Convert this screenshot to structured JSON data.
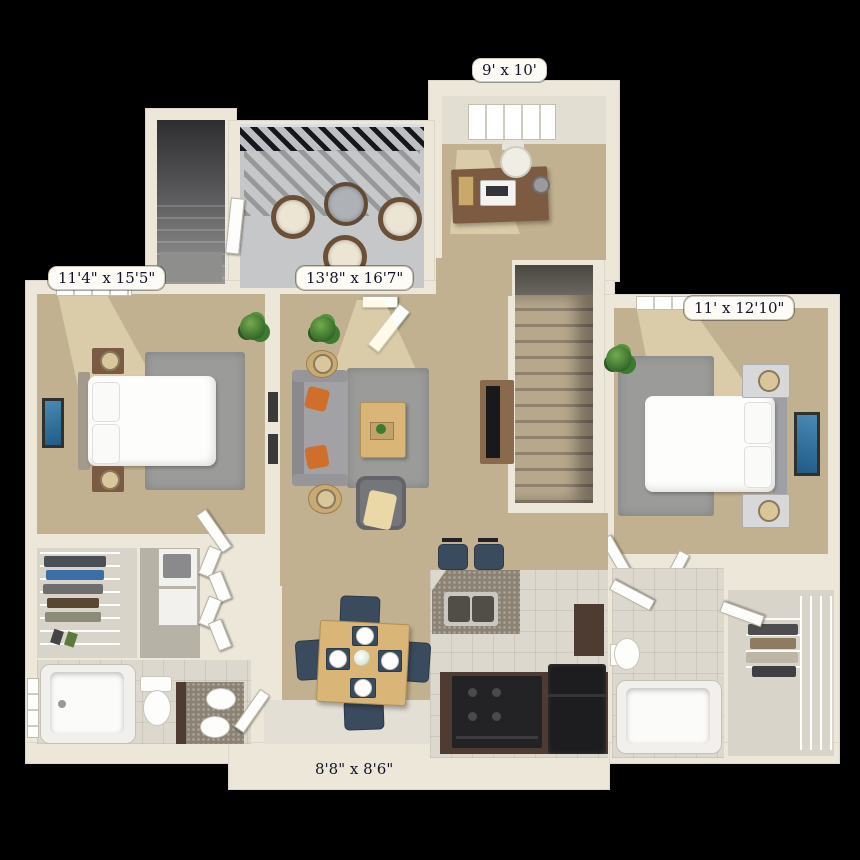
{
  "scene": {
    "kind": "3D apartment floor plan, top-down view",
    "background": "#000000"
  },
  "rooms": {
    "office": {
      "dimensions": "9' x 10'",
      "furniture": [
        "desk",
        "desk-chair",
        "laptop",
        "desk-lamp",
        "window"
      ]
    },
    "balcony": {
      "furniture": [
        "railing",
        "round-glass-table",
        "wicker-chair",
        "wicker-chair",
        "wicker-chair"
      ]
    },
    "entry_stairwell": {
      "furniture": [
        "stairs-down"
      ]
    },
    "bedroom_left": {
      "dimensions": "11'4\" x 15'5\"",
      "furniture": [
        "bed",
        "nightstand",
        "table-lamp",
        "nightstand",
        "table-lamp",
        "area-rug",
        "wall-art",
        "plant",
        "window"
      ]
    },
    "living_room": {
      "dimensions": "13'8\" x 16'7\"",
      "furniture": [
        "sofa",
        "accent-pillows",
        "coffee-table",
        "armchair",
        "tv-console",
        "area-rug",
        "side-table",
        "table-lamp",
        "plant",
        "sliding-door"
      ]
    },
    "stairs": {
      "furniture": [
        "staircase"
      ]
    },
    "bedroom_right": {
      "dimensions": "11' x 12'10\"",
      "furniture": [
        "bed",
        "nightstand",
        "table-lamp",
        "nightstand",
        "table-lamp",
        "area-rug",
        "wall-art",
        "plant",
        "windows"
      ]
    },
    "kitchen": {
      "furniture": [
        "breakfast-bar",
        "double-sink",
        "bar-stool",
        "bar-stool",
        "range",
        "refrigerator",
        "cabinets"
      ]
    },
    "dining": {
      "dimensions": "8'8\" x 8'6\"",
      "furniture": [
        "dining-table",
        "dining-chair",
        "dining-chair",
        "dining-chair",
        "dining-chair",
        "place-settings",
        "flowers"
      ]
    },
    "bathroom_left": {
      "furniture": [
        "bathtub",
        "toilet",
        "double-vanity",
        "window"
      ]
    },
    "bathroom_right": {
      "furniture": [
        "bathtub",
        "toilet",
        "vanity"
      ]
    },
    "closet_left": {
      "furniture": [
        "wire-shelving",
        "clothes"
      ]
    },
    "laundry_closet": {
      "furniture": [
        "stacked-washer-dryer",
        "bifold-doors"
      ]
    },
    "closet_right": {
      "furniture": [
        "wire-shelving",
        "clothes"
      ]
    }
  },
  "palette": {
    "background": "#000000",
    "wall": "#ece7d9",
    "carpet": "#c2b190",
    "rug": "#9b9b99",
    "patio_concrete": "#c6c7c9",
    "tile": "#ddd8cd",
    "wood": "#d9b678",
    "cabinet_brown": "#4e3c33",
    "navy_chair": "#3b4b5e",
    "accent_orange": "#d06f2c",
    "appliance_black": "#1d1d1f",
    "granite": "#8b8274",
    "label_background": "#fcfbf5",
    "label_text": "#131327"
  }
}
